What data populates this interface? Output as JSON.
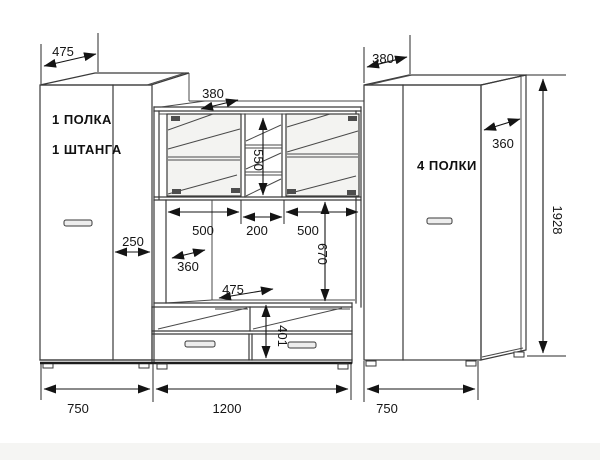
{
  "palette": {
    "background": "#ffffff",
    "line": "#3a3a3a",
    "dimension_line": "#141414",
    "glass_tint": "#f3f3f1",
    "hinge": "#4d4d4d",
    "handle_fill": "#ededed",
    "floor_wash": "#f4f4f2"
  },
  "labels": {
    "left_line1": "1 ПОЛКА",
    "left_line2": "1 ШТАНГА",
    "right": "4 ПОЛКИ"
  },
  "dims": {
    "left_depth": "475",
    "left_side": "250",
    "hutch_depth": "380",
    "glass_height": "550",
    "glass_left": "500",
    "glass_mid": "200",
    "glass_right": "500",
    "niche_depth": "360",
    "niche_height": "670",
    "bench_depth": "475",
    "drawer_height": "401",
    "right_depth": "380",
    "right_side": "360",
    "height_total": "1928",
    "width_left": "750",
    "width_center": "1200",
    "width_right": "750"
  }
}
